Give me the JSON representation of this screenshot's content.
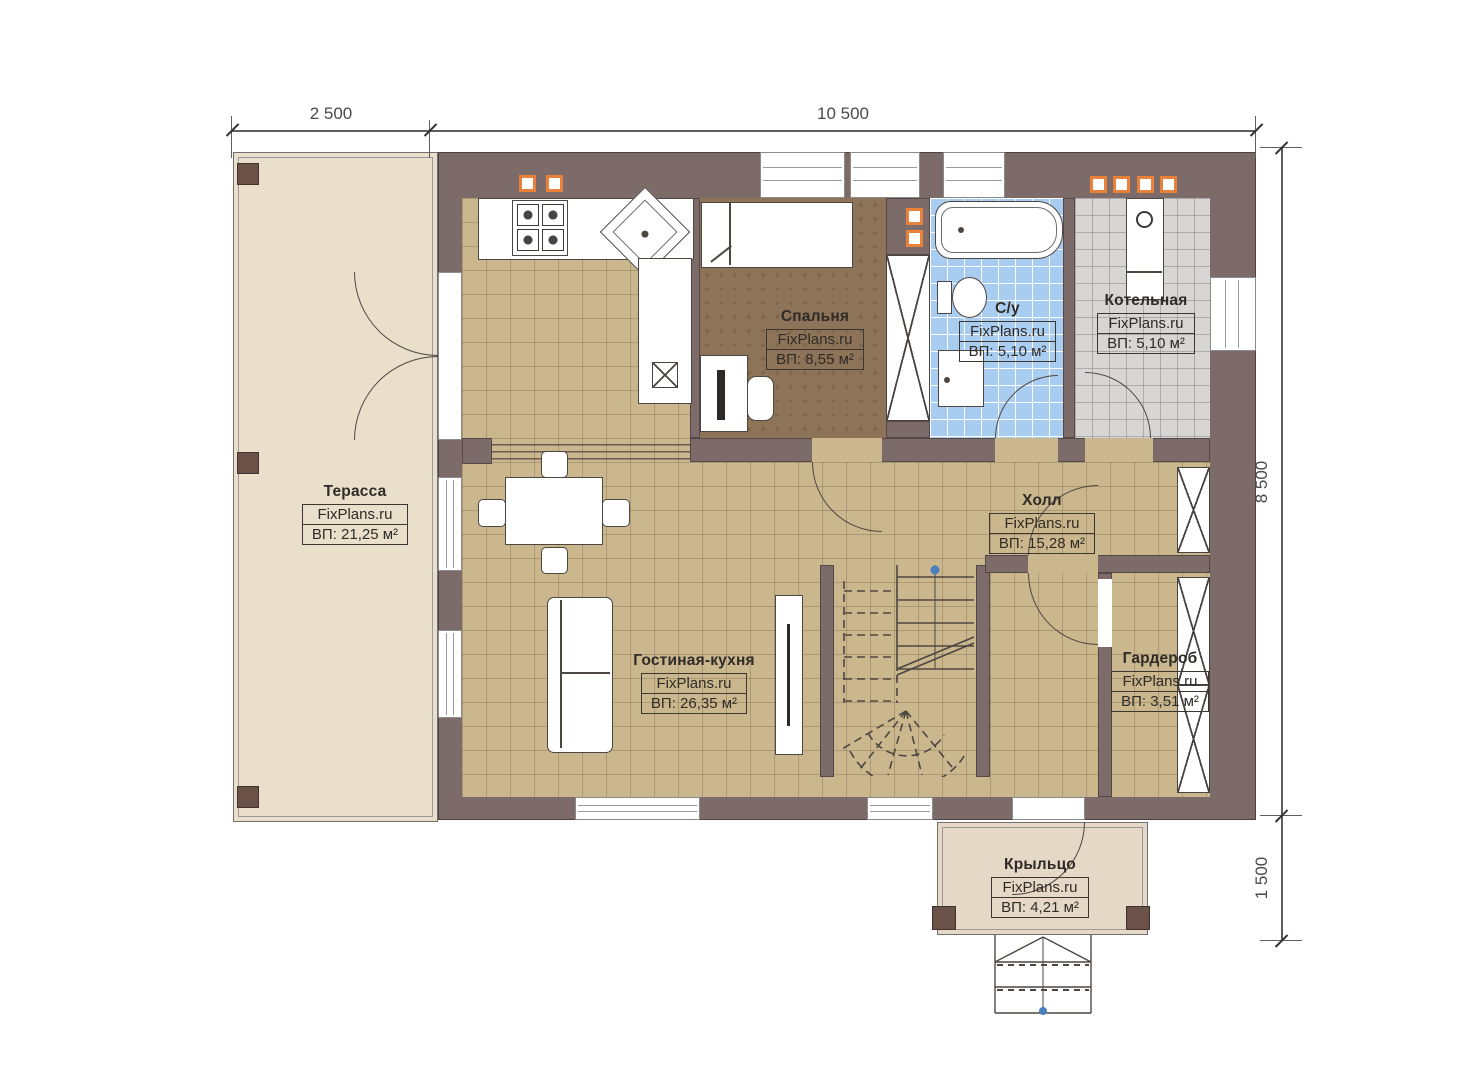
{
  "brand": "FixPlans.ru",
  "dimensions": {
    "width_terrace": "2 500",
    "width_house": "10 500",
    "height_house": "8 500",
    "depth_porch": "1 500"
  },
  "rooms": [
    {
      "name": "Терасса",
      "brand": "FixPlans.ru",
      "area": "ВП: 21,25 м²"
    },
    {
      "name": "Спальня",
      "brand": "FixPlans.ru",
      "area": "ВП: 8,55 м²"
    },
    {
      "name": "С/у",
      "brand": "FixPlans.ru",
      "area": "ВП: 5,10 м²"
    },
    {
      "name": "Котельная",
      "brand": "FixPlans.ru",
      "area": "ВП: 5,10 м²"
    },
    {
      "name": "Холл",
      "brand": "FixPlans.ru",
      "area": "ВП: 15,28 м²"
    },
    {
      "name": "Гостиная-кухня",
      "brand": "FixPlans.ru",
      "area": "ВП: 26,35 м²"
    },
    {
      "name": "Гардероб",
      "brand": "FixPlans.ru",
      "area": "ВП: 3,51 м²"
    },
    {
      "name": "Крыльцо",
      "brand": "FixPlans.ru",
      "area": "ВП: 4,21 м²"
    }
  ],
  "colors": {
    "wall": "#7d6b6a",
    "floor_main": "#cbb78e",
    "floor_bedroom": "#8d7458",
    "floor_bathroom": "#a9cdf0",
    "floor_boiler": "#d7d6d4",
    "terrace": "#e9dfcb",
    "porch": "#e6d8c7",
    "accent_orange": "#e8813a",
    "marker_blue": "#4a7ebd"
  }
}
